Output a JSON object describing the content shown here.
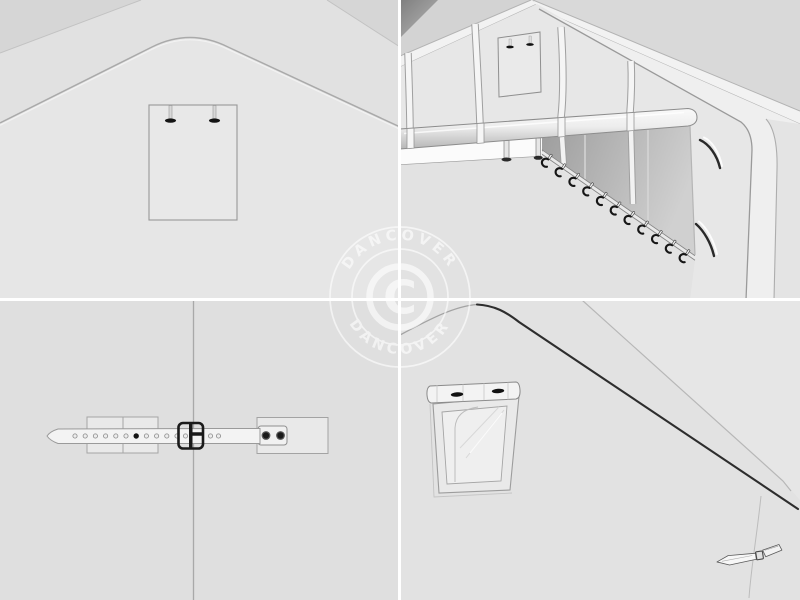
{
  "watermark": {
    "brand_arc_top": "DANCOVER",
    "brand_arc_bottom": "DANCOVER",
    "copyright_letter": "C"
  },
  "palette": {
    "canvas_background": "#e2e2e2",
    "wall_face": "#e7e7e7",
    "outside_shadow_gray": "#d6d6d6",
    "dark_corner_gray": "#868686",
    "line_gray": "#a8a8a8",
    "rope_dark": "#2d2d2d",
    "hardware_dark": "#1a1a1a",
    "white_fabric": "#f4f4f4",
    "opening_shadow_start": "#a0a0a0",
    "opening_shadow_end": "#cfcfcf",
    "divider_white": "#ffffff",
    "watermark_white": "#ffffff"
  }
}
